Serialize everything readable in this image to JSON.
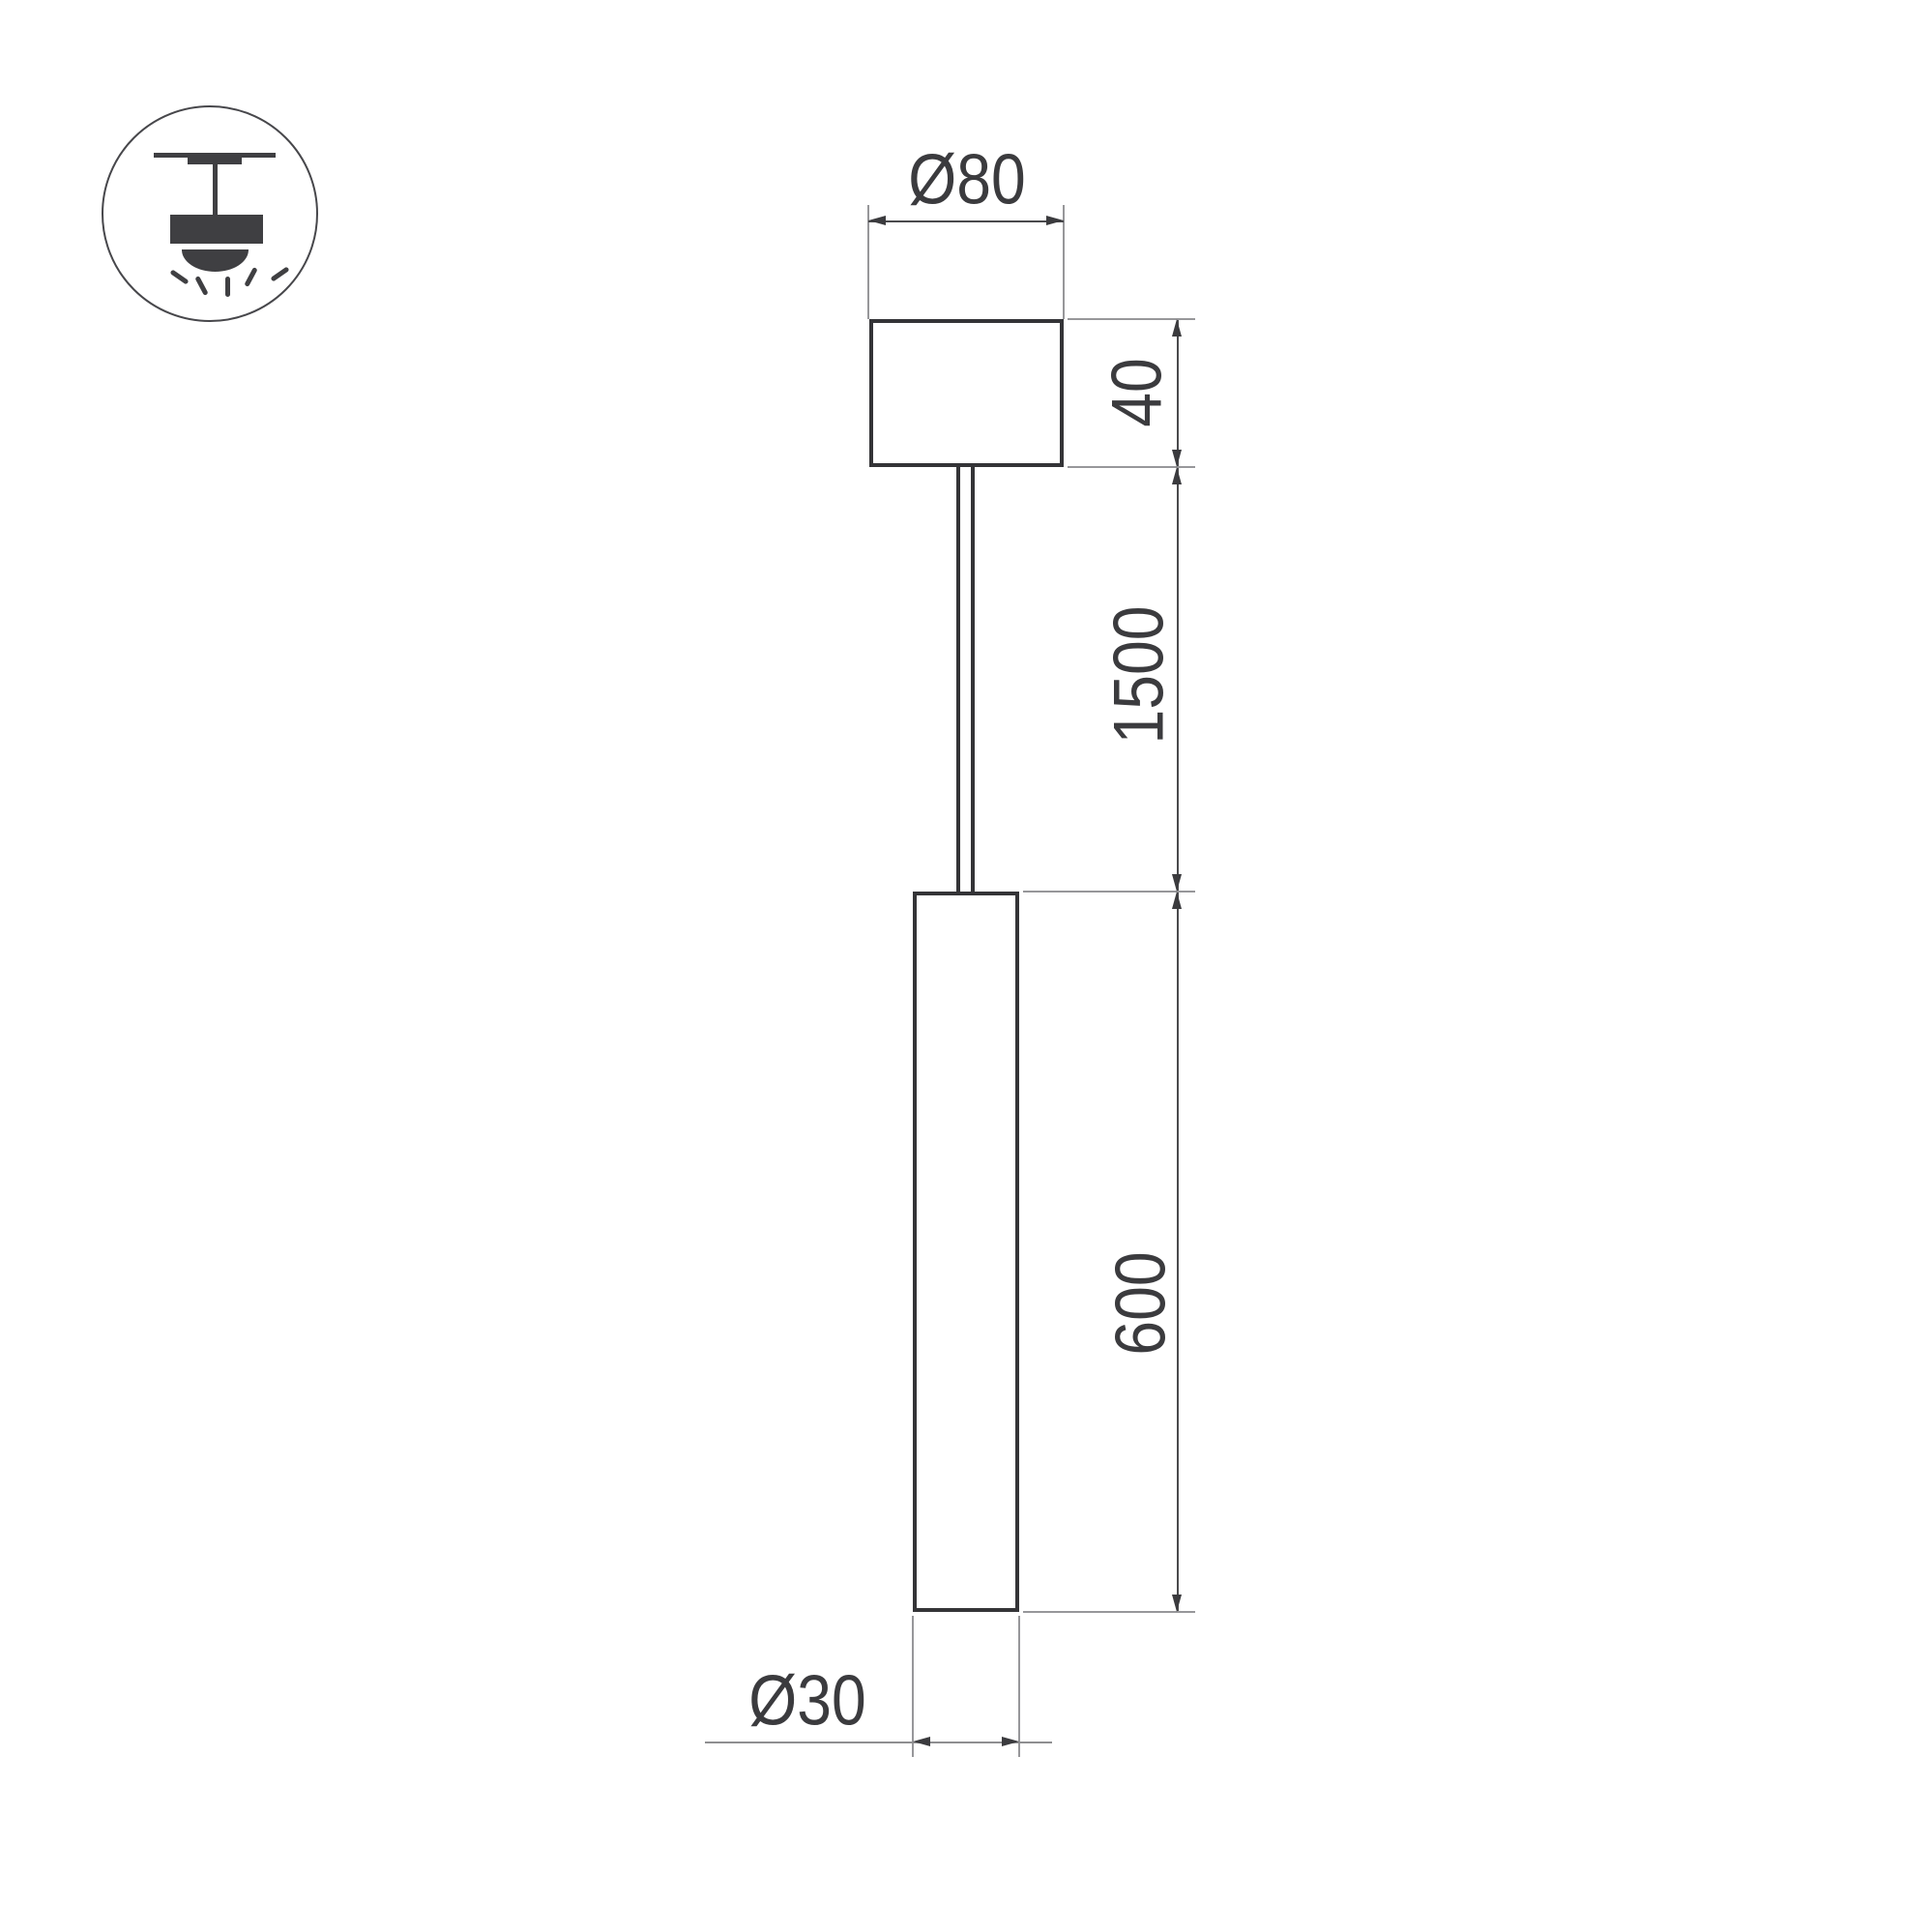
{
  "page": {
    "background": "#ffffff"
  },
  "icon": {
    "name": "pendant-ceiling-light-pictogram",
    "color": "#3f3f42"
  },
  "drawing": {
    "labels": {
      "canopy_diameter": "Ø80",
      "canopy_height": "40",
      "suspension_length": "1500",
      "tube_length": "600",
      "tube_diameter": "Ø30"
    },
    "colors": {
      "object_line": "#343437",
      "dimension_line": "#4a4a4d",
      "extension_line": "#97979a",
      "arrow": "#3b3b3e",
      "text": "#3b3b3e"
    }
  }
}
